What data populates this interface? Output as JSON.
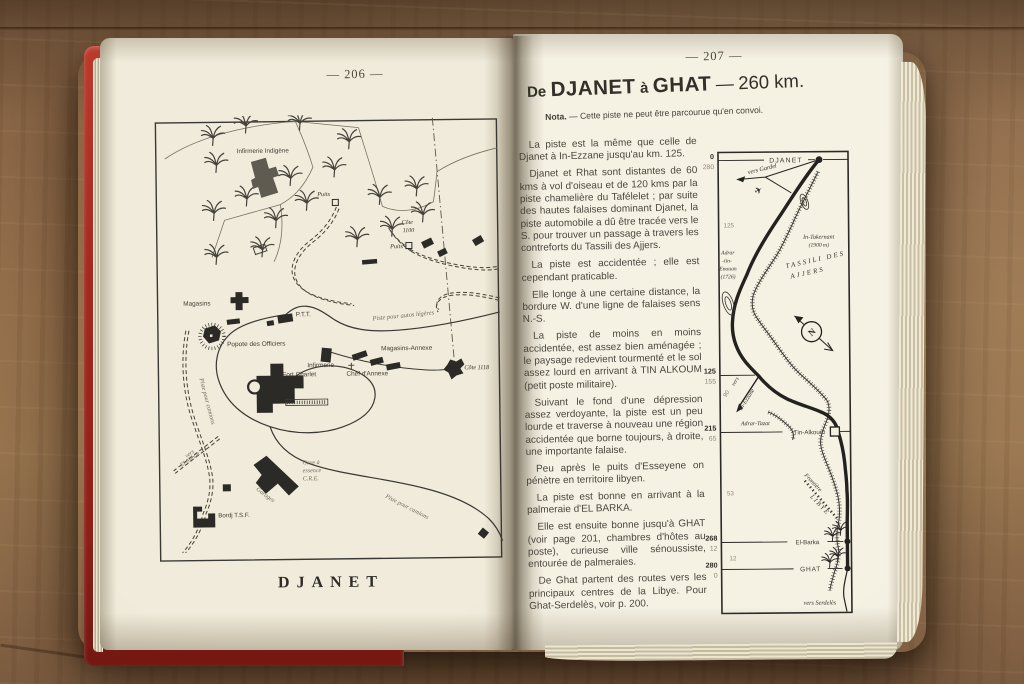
{
  "left_page": {
    "page_number": "— 206 —",
    "caption": "DJANET",
    "map_labels": {
      "infirmerie_indigene": "Infirmerie Indigène",
      "puits_1": "Puits",
      "puits_2": "Puits",
      "cote_1100_line1": "Côte",
      "cote_1100_line2": "1100",
      "magasins": "Magasins",
      "ptt": "P.T.T.",
      "popote": "Popote des Officiers",
      "piste_autos": "Piste pour autos légères",
      "magasins_annexe": "Magasins-Annexe",
      "infirmerie": "Infirmerie",
      "fort_charlet": "Fort Charlet",
      "chef_annexe": "Chef d'Annexe",
      "cote_1118": "Côte 1118",
      "piste_camions_ouest": "Piste pour camions",
      "piste_camions_sud": "Piste pour camions",
      "vers_el_mihan_line1": "vers",
      "vers_el_mihan_line2": "El-Mihan",
      "cave_line1": "Cave à",
      "cave_line2": "essence",
      "cave_line3": "C.R.E.",
      "garages": "Garages",
      "bordj_tsf": "Bordj T.S.F."
    }
  },
  "right_page": {
    "page_number": "— 207 —",
    "title": {
      "de": "De",
      "from": "DJANET",
      "a": "à",
      "to": "GHAT",
      "dash": "—",
      "distance": "260 km."
    },
    "nota_label": "Nota.",
    "nota_text": " — Cette piste ne peut être parcourue qu'en convoi.",
    "paragraphs": [
      "La piste est la même que celle de Djanet à In-Ezzane jusqu'au km. 125.",
      "Djanet et Rhat sont distantes de 60 kms à vol d'oiseau et de 120 kms par la piste chamelière du Tafélelet ; par suite des hautes falaises dominant Djanet, la piste automobile a dû être tracée vers le S. pour trouver un passage à travers les contreforts du Tassili des Ajjers.",
      "La piste est accidentée ; elle est cependant praticable.",
      "Elle longe à une certaine distance, la bordure W. d'une ligne de falaises sens N.-S.",
      "La piste de moins en moins accidentée, est assez bien aménagée ; le paysage redevient tourmenté et le sol assez lourd en arrivant à TIN ALKOUM (petit poste militaire).",
      "Suivant le fond d'une dépression assez verdoyante, la piste est un peu lourde et traverse à nouveau une région accidentée que borne toujours, à droite, une importante falaise.",
      "Peu après le puits d'Esseyene on pénètre en territoire libyen.",
      "La piste est bonne en arrivant à la palmeraie d'EL BARKA.",
      "Elle est ensuite bonne jusqu'à GHAT (voir page 201, chambres d'hôtes au poste), curieuse ville sénoussiste, entourée de palmeraies.",
      "De Ghat partent des routes vers les principaux centres de la Libye. Pour Ghat-Serdelès, voir p. 200."
    ],
    "km_column": [
      {
        "km": "0",
        "reverse": "280"
      },
      {
        "km": "125",
        "reverse": "155"
      },
      {
        "km": "215",
        "reverse": "65"
      },
      {
        "km": "268",
        "reverse": "12"
      },
      {
        "km": "280",
        "reverse": "0"
      }
    ],
    "segment_distances": {
      "djanet_junction": "125",
      "branch_in_ezzane": "90",
      "tin_alkoum_el_barka": "53",
      "el_barka_ghat": "12"
    },
    "route_labels": {
      "djanet": "DJANET",
      "vers_gardel": "vers Gardel",
      "in_takernant": "In-Takernant",
      "in_takernant_elev": "(1900  m)",
      "tassili_line1": "TASSILI DES",
      "tassili_line2": "AJJERS",
      "adrar_line1": "Adrar",
      "adrar_line2": "-tin-",
      "adrar_line3": "Enouan",
      "adrar_line4": "(1726)",
      "north": "N",
      "vers": "vers",
      "in_ezzane": "In-Ezzane",
      "adrar_tazat": "Adrar-Tazat",
      "tin_alkoum": "Tin-Alkoum",
      "frontiere": "Frontière",
      "libye": "L I B Y E",
      "el_barka": "El-Barka",
      "ghat": "GHAT",
      "vers_serdeles": "vers Serdelès"
    }
  }
}
